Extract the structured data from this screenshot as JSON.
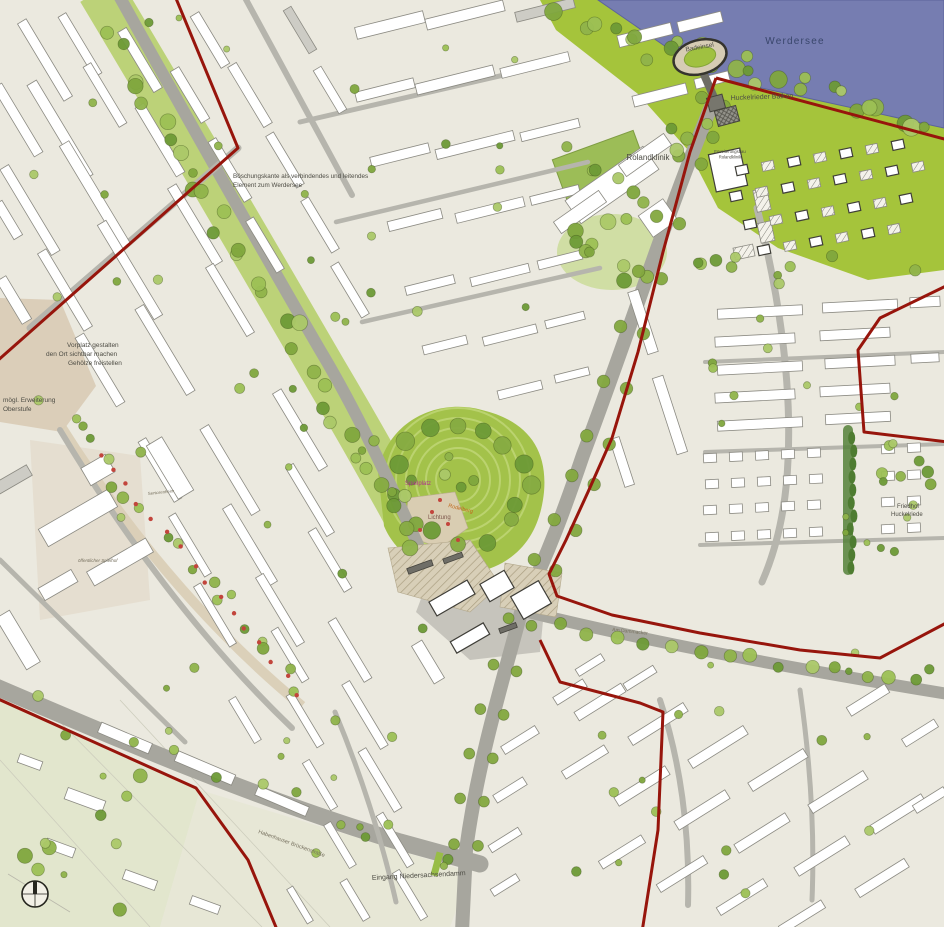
{
  "map": {
    "type": "urban-development-masterplan",
    "labels": {
      "werdersee": "Werdersee",
      "badeinsel": "Badeinsel",
      "balkon": "Huckelrieder Balkon",
      "rolandklinik": "Rolandklinik",
      "erweiterung_1": "Erweiterungsbau",
      "erweiterung_2": "Rolandklinik",
      "gruen_1": "Böschungskante als verbindendes und leitendes",
      "gruen_2": "Element zum Werdersee",
      "vorplatz_1": "Vorplatz gestalten",
      "vorplatz_2": "den Ort sichtbar machen",
      "vorplatz_3": "Gehölze freistellen",
      "schule_1": "mögl. Erweiterung",
      "schule_2": "Oberstufe",
      "friedhof_1": "Friedhof",
      "friedhof_2": "Huckelriede",
      "eingang": "Eingang  Niedersachsendamm",
      "strasse_sw": "Habenhauser Brückenstraße",
      "strasse_o": "Am Dammacker",
      "spielplatz": "Spielplatz",
      "lichtung": "Lichtung",
      "rodelberg": "Rodelberg",
      "spielhof": "öffentlicher Spielhof",
      "seniorenheim": "Seniorenheim"
    },
    "colors": {
      "ground": "#ebe9df",
      "pale_green": "#e2e6cd",
      "water": "#767db1",
      "shore_green": "#a5c43b",
      "corridor_green": "#b7cf6d",
      "park_green": "#a3c24a",
      "tree_green": "#7fa63d",
      "road_gray": "#a7a69e",
      "road_minor": "#b6b5ad",
      "building_white": "#ffffff",
      "building_stroke": "#8b8a82",
      "building_new_stroke": "#3f3e38",
      "boundary_red": "#97150c",
      "plaza_tan": "#d6ccb4",
      "accent_red": "#c2453c",
      "label_dark": "#4d4c44",
      "water_label": "#39466b",
      "label_magenta": "#b0308f",
      "label_orange": "#c06a1e",
      "label_brown": "#7d564b",
      "label_faint": "#77715f"
    }
  }
}
